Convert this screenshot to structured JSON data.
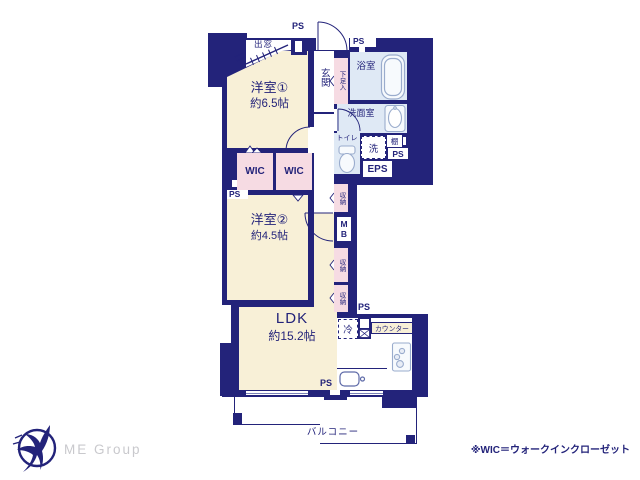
{
  "palette": {
    "wall_navy": "#23237a",
    "room_cream": "#f8f0d7",
    "closet_pink": "#f6dbe3",
    "wet_area_blue": "#dfe9f5",
    "fixture_stroke": "#9aaccd",
    "logo_gray": "#c9c9cd"
  },
  "rooms": {
    "western1": {
      "name": "洋室①",
      "size": "約6.5帖"
    },
    "western2": {
      "name": "洋室②",
      "size": "約4.5帖"
    },
    "ldk": {
      "name": "LDK",
      "size": "約15.2帖"
    }
  },
  "labels": {
    "wic": "WIC",
    "genkan": "玄関",
    "shoe_box": "下足入",
    "bathroom": "浴室",
    "washroom": "洗面室",
    "toilet": "トイレ",
    "washer": "洗",
    "shelf": "棚",
    "eps": "EPS",
    "mb": "MB",
    "closet": "収納",
    "fridge": "冷",
    "counter": "カウンター",
    "balcony": "バルコニー",
    "bay_window": "出窓",
    "ps": "PS"
  },
  "footer": {
    "logo_text": "ME Group",
    "note": "※WIC＝ウォークインクローゼット"
  }
}
